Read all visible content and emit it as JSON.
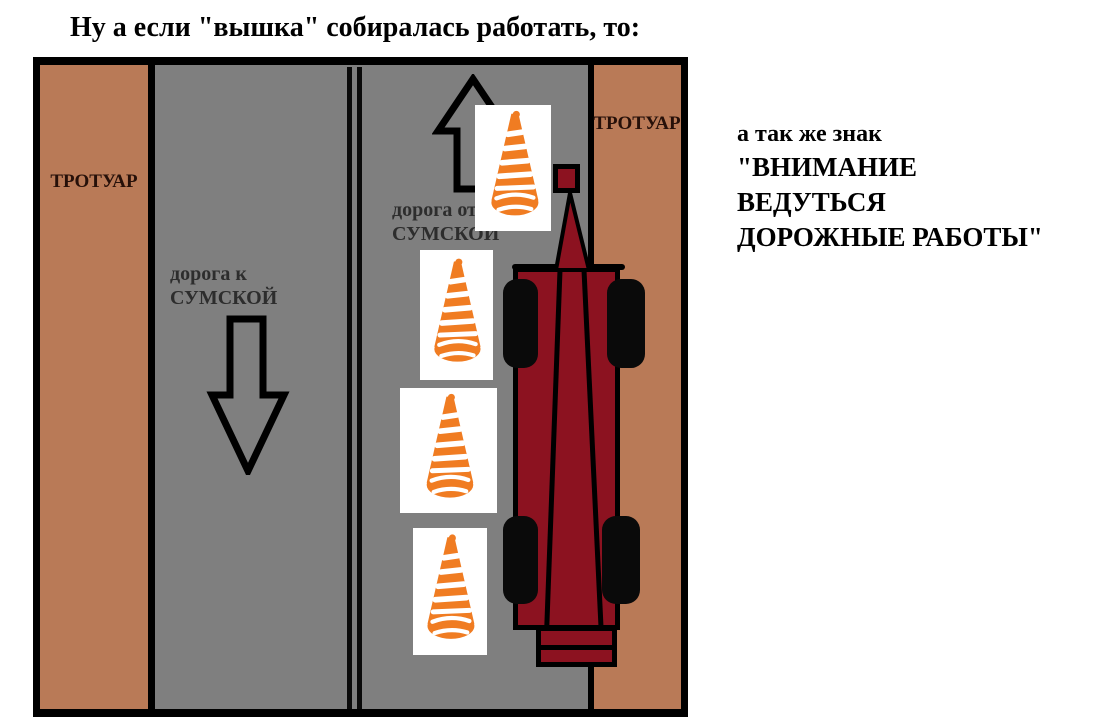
{
  "title": "Ну а если \"вышка\" собиралась работать, то:",
  "side_note": {
    "lines": [
      "а так же знак",
      "\"ВНИМАНИЕ",
      "ВЕДУТЬСЯ",
      "ДОРОЖНЫЕ РАБОТЫ\""
    ]
  },
  "diagram": {
    "left_sidewalk": {
      "label": "ТРОТУАР"
    },
    "right_sidewalk": {
      "label": "ТРОТУАР"
    },
    "lane_to_sumska": {
      "line1": "дорога к",
      "line2": "СУМСКОЙ"
    },
    "lane_from_sumska": {
      "line1": "дорога от",
      "line2": "СУМСКОЙ"
    },
    "icons": {
      "up_arrow": "arrow-up-icon",
      "down_arrow": "arrow-down-icon",
      "cones": [
        "traffic-cone-icon",
        "traffic-cone-icon",
        "traffic-cone-icon",
        "traffic-cone-icon"
      ],
      "truck": "aerial-lift-truck"
    },
    "colors": {
      "sidewalk": "#b97a57",
      "road": "#7f7f7f",
      "outline": "#000000",
      "truck_body": "#8c1220",
      "cone_orange": "#f07c22",
      "cone_background": "#ffffff",
      "centerline": "#0a0a0a"
    }
  }
}
